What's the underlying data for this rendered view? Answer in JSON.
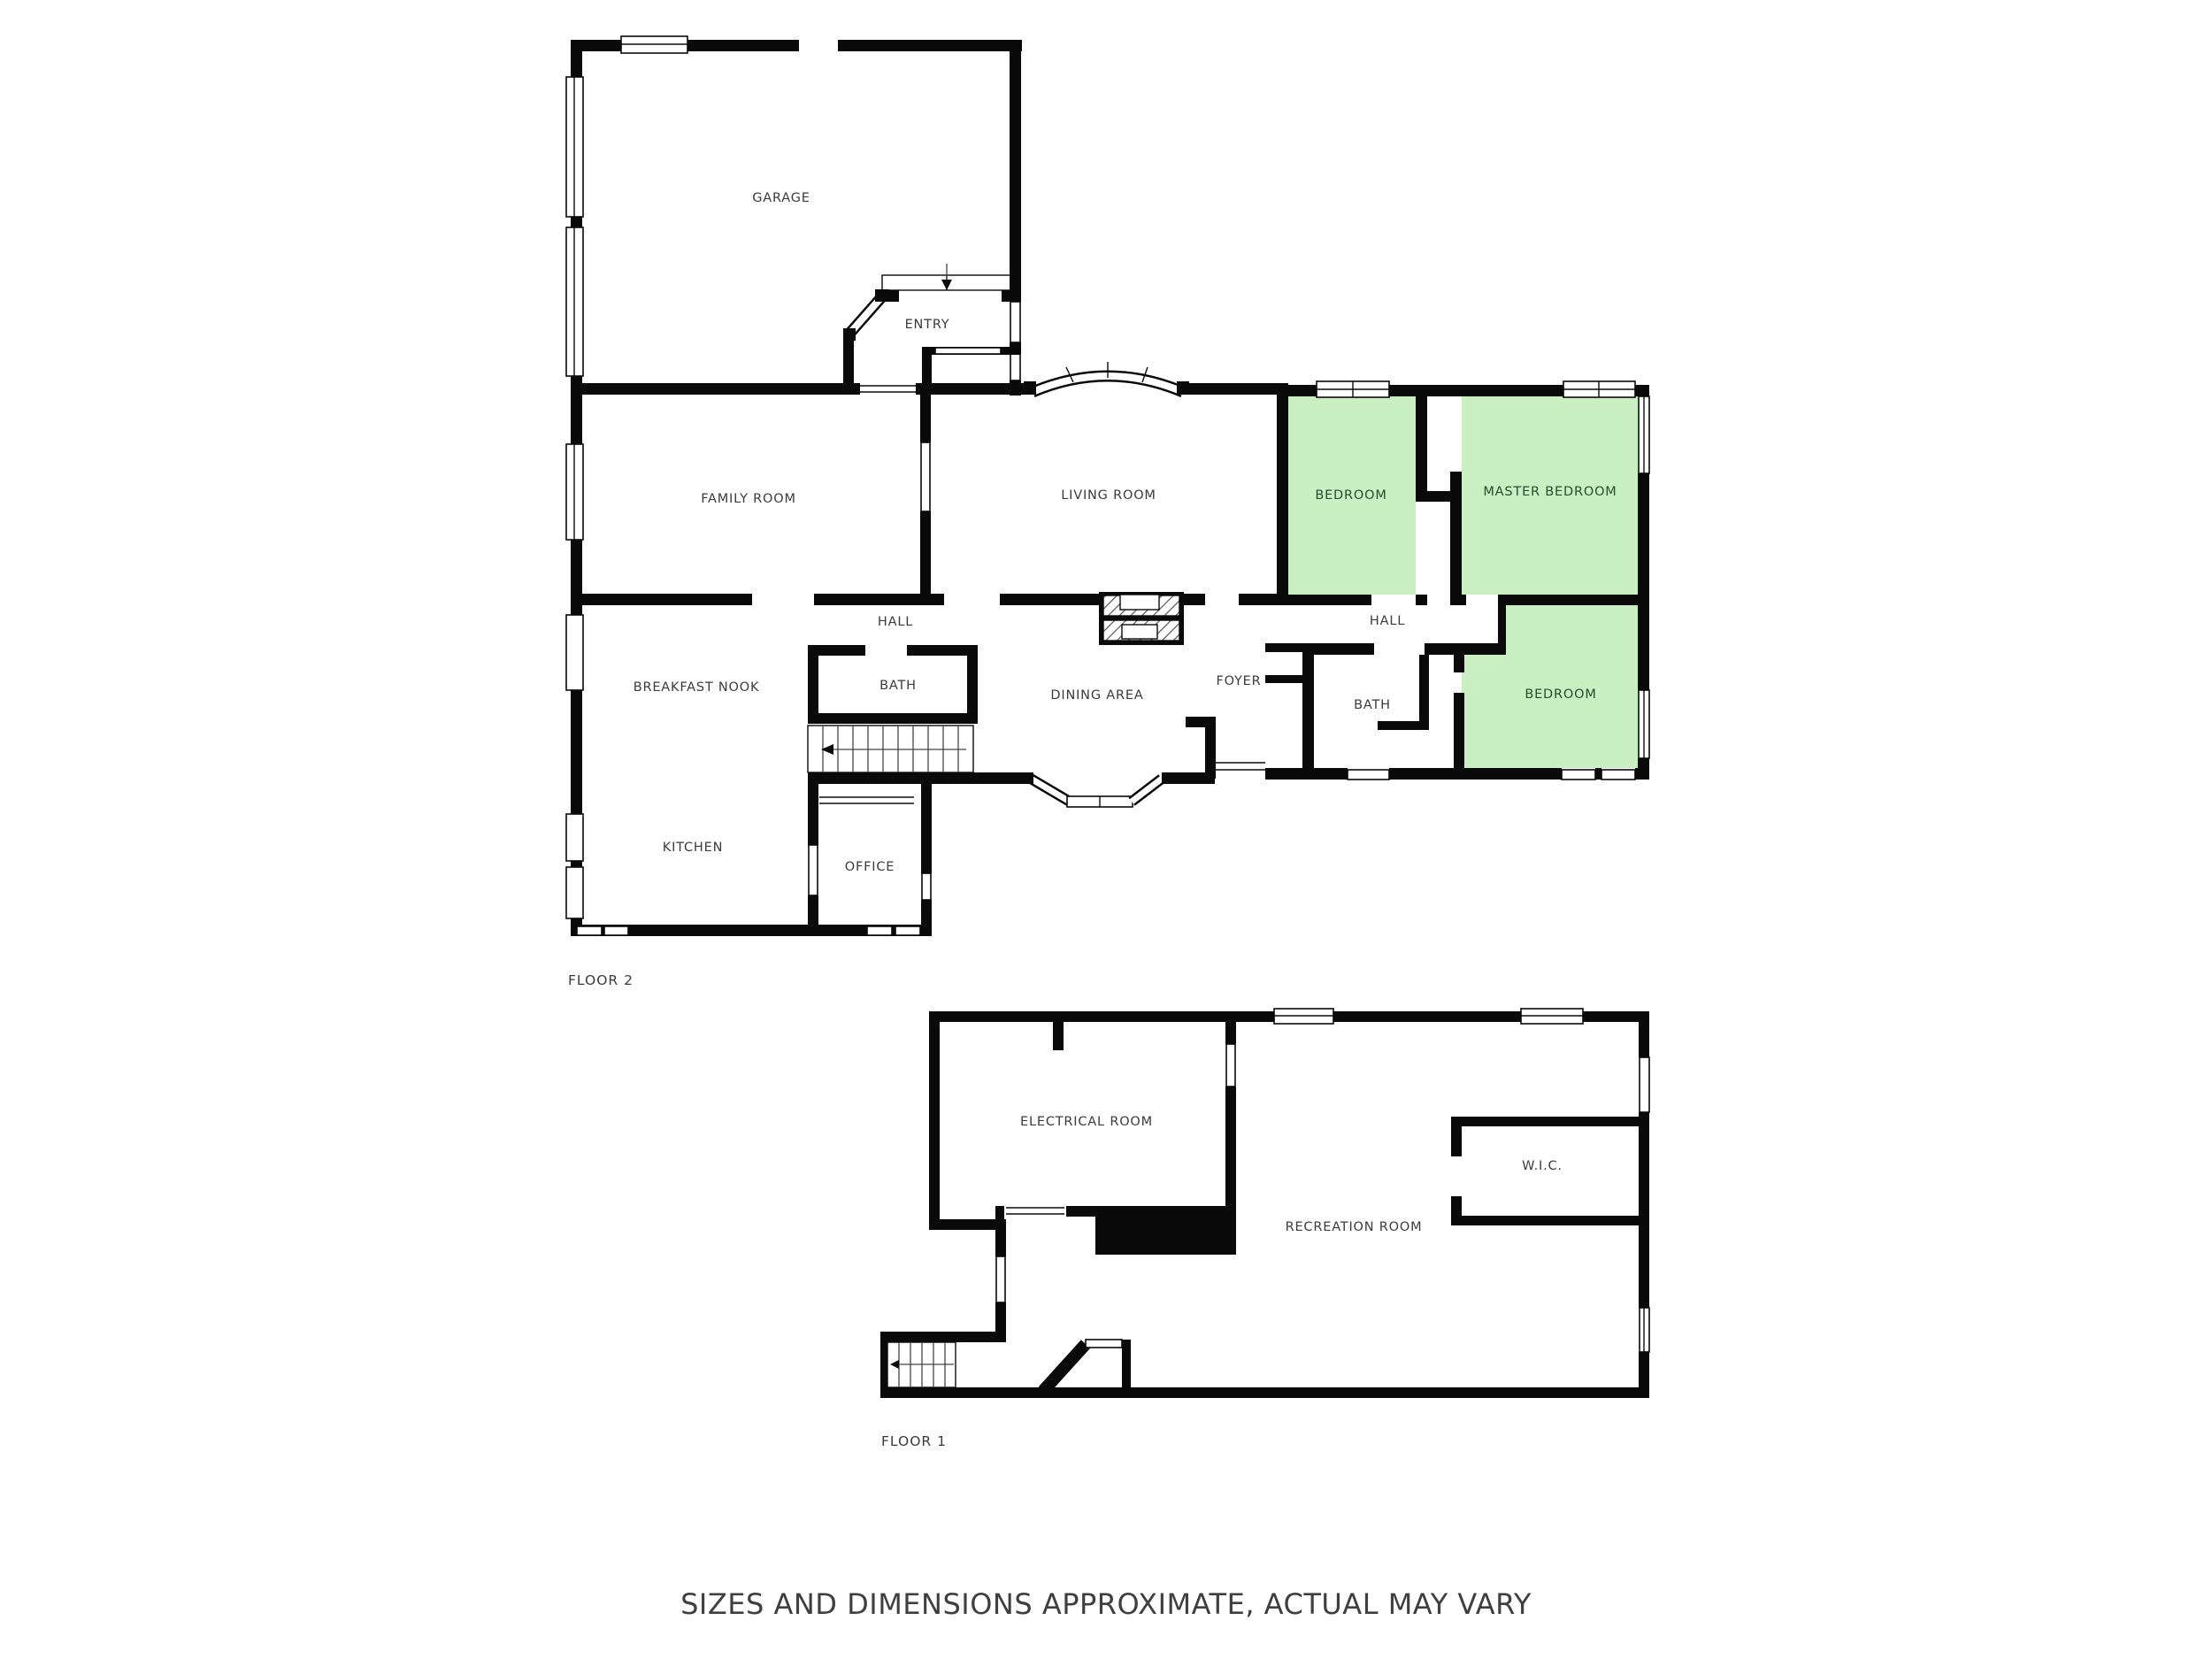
{
  "floor2": {
    "label": "FLOOR 2",
    "rooms": {
      "garage": "GARAGE",
      "entry": "ENTRY",
      "family_room": "FAMILY ROOM",
      "living_room": "LIVING ROOM",
      "bedroom_mid": "BEDROOM",
      "master_bedroom": "MASTER BEDROOM",
      "hall_left": "HALL",
      "hall_right": "HALL",
      "breakfast_nook": "BREAKFAST NOOK",
      "bath_left": "BATH",
      "dining_area": "DINING AREA",
      "foyer": "FOYER",
      "bath_right": "BATH",
      "bedroom_right": "BEDROOM",
      "kitchen": "KITCHEN",
      "office": "OFFICE"
    }
  },
  "floor1": {
    "label": "FLOOR 1",
    "rooms": {
      "electrical_room": "ELECTRICAL ROOM",
      "recreation_room": "RECREATION ROOM",
      "wic": "W.I.C."
    }
  },
  "footer": {
    "disclaimer": "SIZES AND DIMENSIONS APPROXIMATE, ACTUAL MAY VARY"
  },
  "colors": {
    "highlight_room_fill": "#c9efc3",
    "wall": "#0a0a0a",
    "label": "#3b3b3b"
  }
}
